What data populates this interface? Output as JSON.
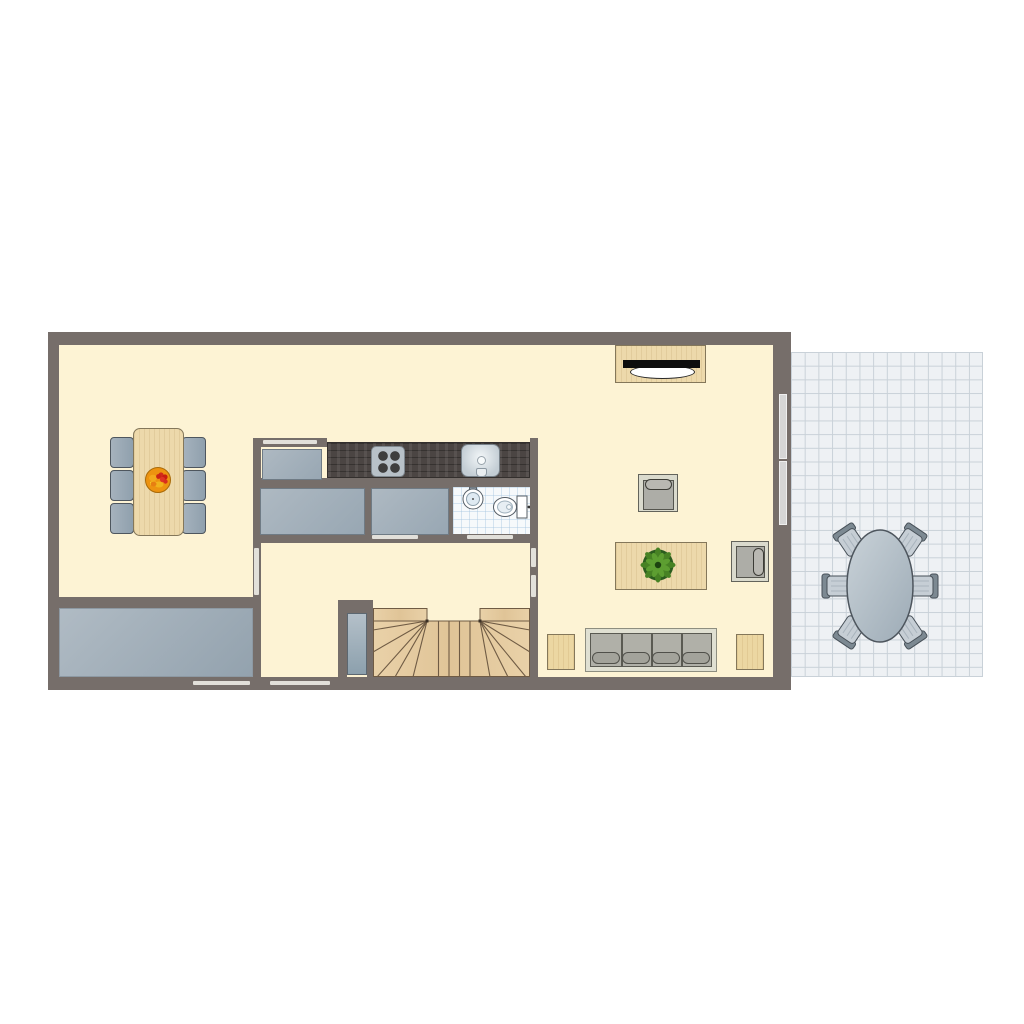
{
  "title": "Apartment ground-floor plan with patio terrace",
  "palette": {
    "wall": "#766e6a",
    "floor_cream": "#fdf3d4",
    "wood_light": "#edd9ab",
    "counter_dark_wood": "#4b4543",
    "furniture_grayblue": "#a6b2bd",
    "upholstery_gray": "#b0b0a8",
    "patio_tile": "#eef1f4",
    "patio_tile_line": "#c9d1d8",
    "plant_green": "#478224",
    "fruit_orange": "#ed9310",
    "door_opening": "#e2e0da",
    "window_glass": "#d6d6d6"
  },
  "rooms": [
    {
      "id": "dining-area",
      "label": "Dining area",
      "floor": "cream"
    },
    {
      "id": "kitchen",
      "label": "Kitchen",
      "floor": "cream"
    },
    {
      "id": "bathroom",
      "label": "Bathroom / WC",
      "floor": "white-blue tiles"
    },
    {
      "id": "hallway",
      "label": "Hallway",
      "floor": "cream"
    },
    {
      "id": "balcony-storage",
      "label": "Balcony / storage room",
      "floor": "gray-blue"
    },
    {
      "id": "living-room",
      "label": "Living room",
      "floor": "cream"
    },
    {
      "id": "staircase",
      "label": "Staircase",
      "floor": "wood"
    },
    {
      "id": "patio-terrace",
      "label": "Patio terrace",
      "floor": "tiled grid"
    }
  ],
  "furniture": {
    "dining": {
      "table": "rectangular wood table",
      "chairs": 6,
      "table_item": "fruit bowl"
    },
    "kitchen": {
      "counter": "dark wood worktop",
      "stove_burners": 4,
      "sink": 1,
      "fridge_or_cabinet": 1,
      "islands": 2
    },
    "bathroom": {
      "sink": 1,
      "toilet": 1
    },
    "living": {
      "sideboard_with_tv": 1,
      "armchairs": 2,
      "coffee_table": 1,
      "plant": 1,
      "sofa_seats": 4,
      "side_tables": 2
    },
    "staircase": {
      "type": "double-winder U-stair",
      "flights": 2
    },
    "patio": {
      "table": "oval",
      "chairs": 6
    }
  },
  "openings": {
    "interior_door_markings": 6,
    "exterior_door_markings": 2,
    "windows_right_wall": 2
  }
}
